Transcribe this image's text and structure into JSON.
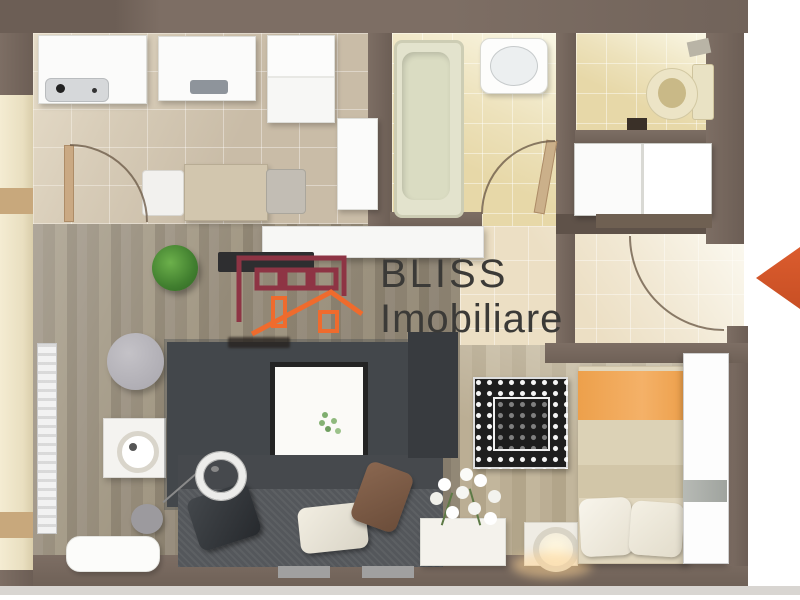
{
  "watermark": {
    "brand_line1": "BLISS",
    "brand_line2": "Imobiliare",
    "text_color": "#3b3a37",
    "logo": {
      "building_color": "#8e3444",
      "house_color": "#ef6b2d"
    }
  },
  "entrance_arrow": {
    "color": "#d4582a",
    "direction": "left"
  },
  "palette": {
    "wall": "#77685e",
    "kitchen_tile": "#c9bca7",
    "bathroom_tile": "#e7d8a8",
    "hall_tile": "#ecdfc4",
    "living_wood": "#9b9181",
    "bedroom_wood": "#b7aa8f",
    "balcony": "#efe5c6",
    "dark_rug": "#43474b",
    "patterned_rug": "#1e1e1e",
    "bed_blanket_orange": "#f0a652",
    "sofa": "#54575b"
  },
  "rooms": [
    {
      "id": "kitchen",
      "furniture": [
        "sink-counter",
        "stove-counter",
        "fridge",
        "tall-cabinet",
        "dining-table",
        "chairs",
        "door-arc"
      ]
    },
    {
      "id": "bathroom",
      "furniture": [
        "bathtub",
        "wash-basin",
        "door-arc"
      ]
    },
    {
      "id": "wc",
      "furniture": [
        "toilet"
      ]
    },
    {
      "id": "hallway",
      "furniture": [
        "wardrobe",
        "entry-door-arc"
      ]
    },
    {
      "id": "living-room",
      "furniture": [
        "sofa",
        "dark-rug",
        "coffee-table",
        "arc-floor-lamp",
        "tv-cabinet",
        "tv",
        "radiator",
        "plant",
        "pouf",
        "side-table",
        "console-table"
      ]
    },
    {
      "id": "bedroom",
      "furniture": [
        "bed",
        "wardrobe-column",
        "patterned-rug",
        "flower-planter",
        "bedside-lamp"
      ]
    },
    {
      "id": "balcony",
      "furniture": [
        "window-front"
      ]
    }
  ]
}
